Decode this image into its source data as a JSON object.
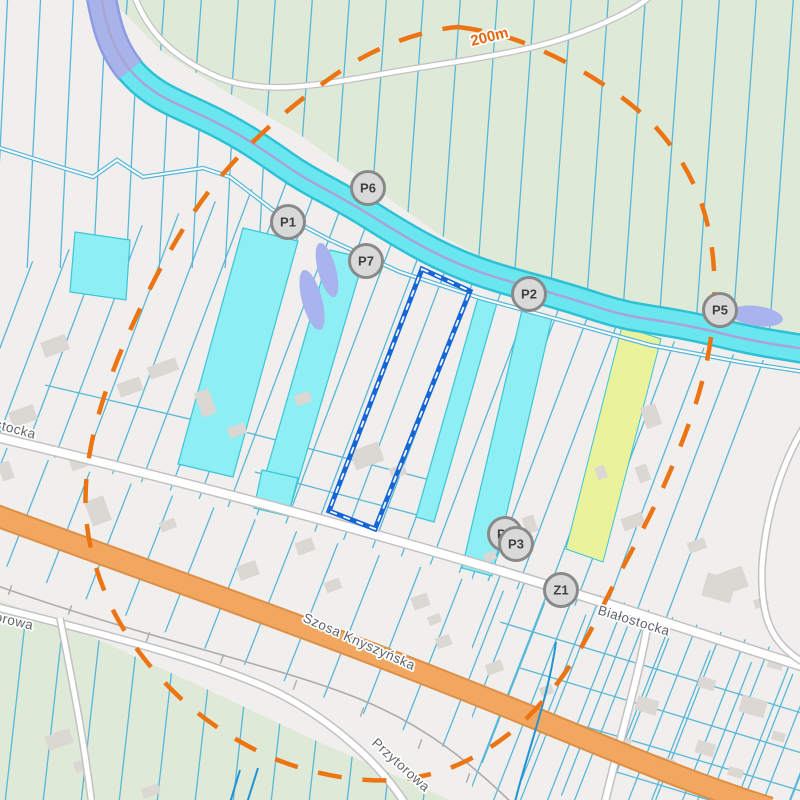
{
  "map_view": {
    "buffer": {
      "label": "200m",
      "x": 472,
      "y": 46,
      "rotate": -14
    },
    "markers": [
      {
        "id": "P1",
        "x": 288,
        "y": 222
      },
      {
        "id": "P6",
        "x": 368,
        "y": 188
      },
      {
        "id": "P7",
        "x": 366,
        "y": 261
      },
      {
        "id": "P2",
        "x": 529,
        "y": 294
      },
      {
        "id": "P5",
        "x": 720,
        "y": 310
      },
      {
        "id": "P4",
        "x": 505,
        "y": 534
      },
      {
        "id": "P3",
        "x": 516,
        "y": 544
      },
      {
        "id": "Z1",
        "x": 561,
        "y": 590
      }
    ],
    "street_labels": [
      {
        "text": "stocka",
        "x": -6,
        "y": 428,
        "rotate": 15
      },
      {
        "text": "Białostocka",
        "x": 597,
        "y": 614,
        "rotate": 17
      },
      {
        "text": "Szosa Knyszyńska",
        "x": 302,
        "y": 621,
        "rotate": 24
      },
      {
        "text": "orowa",
        "x": -6,
        "y": 621,
        "rotate": 13
      },
      {
        "text": "Przytorowa",
        "x": 371,
        "y": 744,
        "rotate": 42
      }
    ],
    "colors": {
      "background": "#f0efed",
      "field_green": "#dfe9d7",
      "parcel_line": "#58b7d9",
      "river_fill": "#69e6ee",
      "river_edge": "#2fc0d6",
      "river_center": "#aaa3d6",
      "river_upper": "#a8b3ea",
      "river_upper_edge": "#8d9ce2",
      "pond": "#a9b3ee",
      "highlight_cyan": "#8deef3",
      "highlight_cyan_edge": "#3cc4d8",
      "highlight_yellow": "#eaf29b",
      "road_fill": "#ffffff",
      "road_casing": "#c2c2c2",
      "main_road_fill": "#f1a75f",
      "main_road_casing": "#de8f45",
      "railway": "#ababab",
      "buffer_dash": "#ec7412",
      "buffer_label": "#e8640c",
      "selection_blue": "#1566d6",
      "marker_fill": "#d9d9d9",
      "marker_border": "#898989",
      "marker_text": "#3f3f3f",
      "street_label": "#5f6368",
      "utility_line": "#1f93d4",
      "building": "#dbd7d3"
    }
  }
}
